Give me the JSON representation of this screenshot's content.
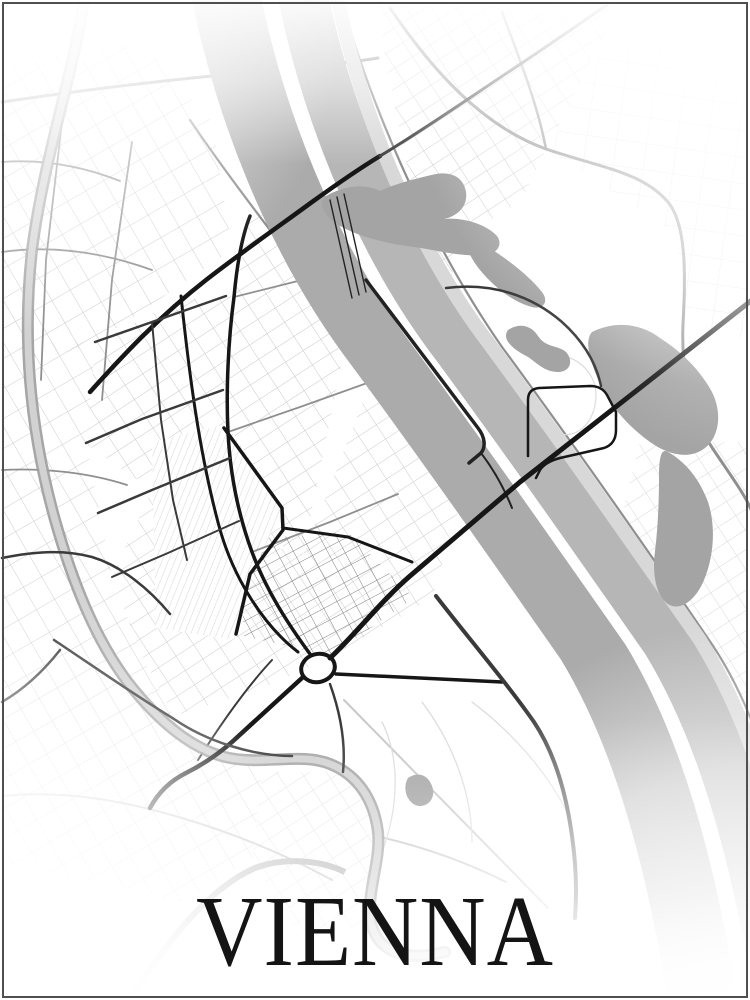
{
  "poster": {
    "title": "VIENNA",
    "style": "minimalist black-and-white street map poster"
  },
  "colors": {
    "background": "#ffffff",
    "frame": "#4f4f4f",
    "title": "#141414",
    "water": "#ababab",
    "water_secondary": "#b6b6b6",
    "water_bank": "#d8d8d8",
    "canal_edge": "#9c9c9c",
    "canal_fill": "#d2d2d2",
    "lake": "#a4a4a4",
    "road_black": "#161616",
    "road_dark": "#3a3a3a",
    "road_medium": "#8f8f8f",
    "road_light": "#c8c8c8",
    "road_faint": "#dcdcdc",
    "rail": "#222222"
  },
  "features": [
    "danube-river",
    "donauinsel-island-gap",
    "neue-donau-channel",
    "river-bank-strip",
    "danube-canal",
    "wien-river",
    "alte-donau-lakes",
    "kaiserwasser-pond",
    "prater-pond",
    "railway-yard",
    "railway-line",
    "praterstern-roundabout",
    "reichsbruecke-axis-road",
    "floridsdorfer-bridge-road",
    "major-road-network",
    "minor-street-grid",
    "prater-park-paths",
    "edge-vignette-fade",
    "poster-frame"
  ]
}
